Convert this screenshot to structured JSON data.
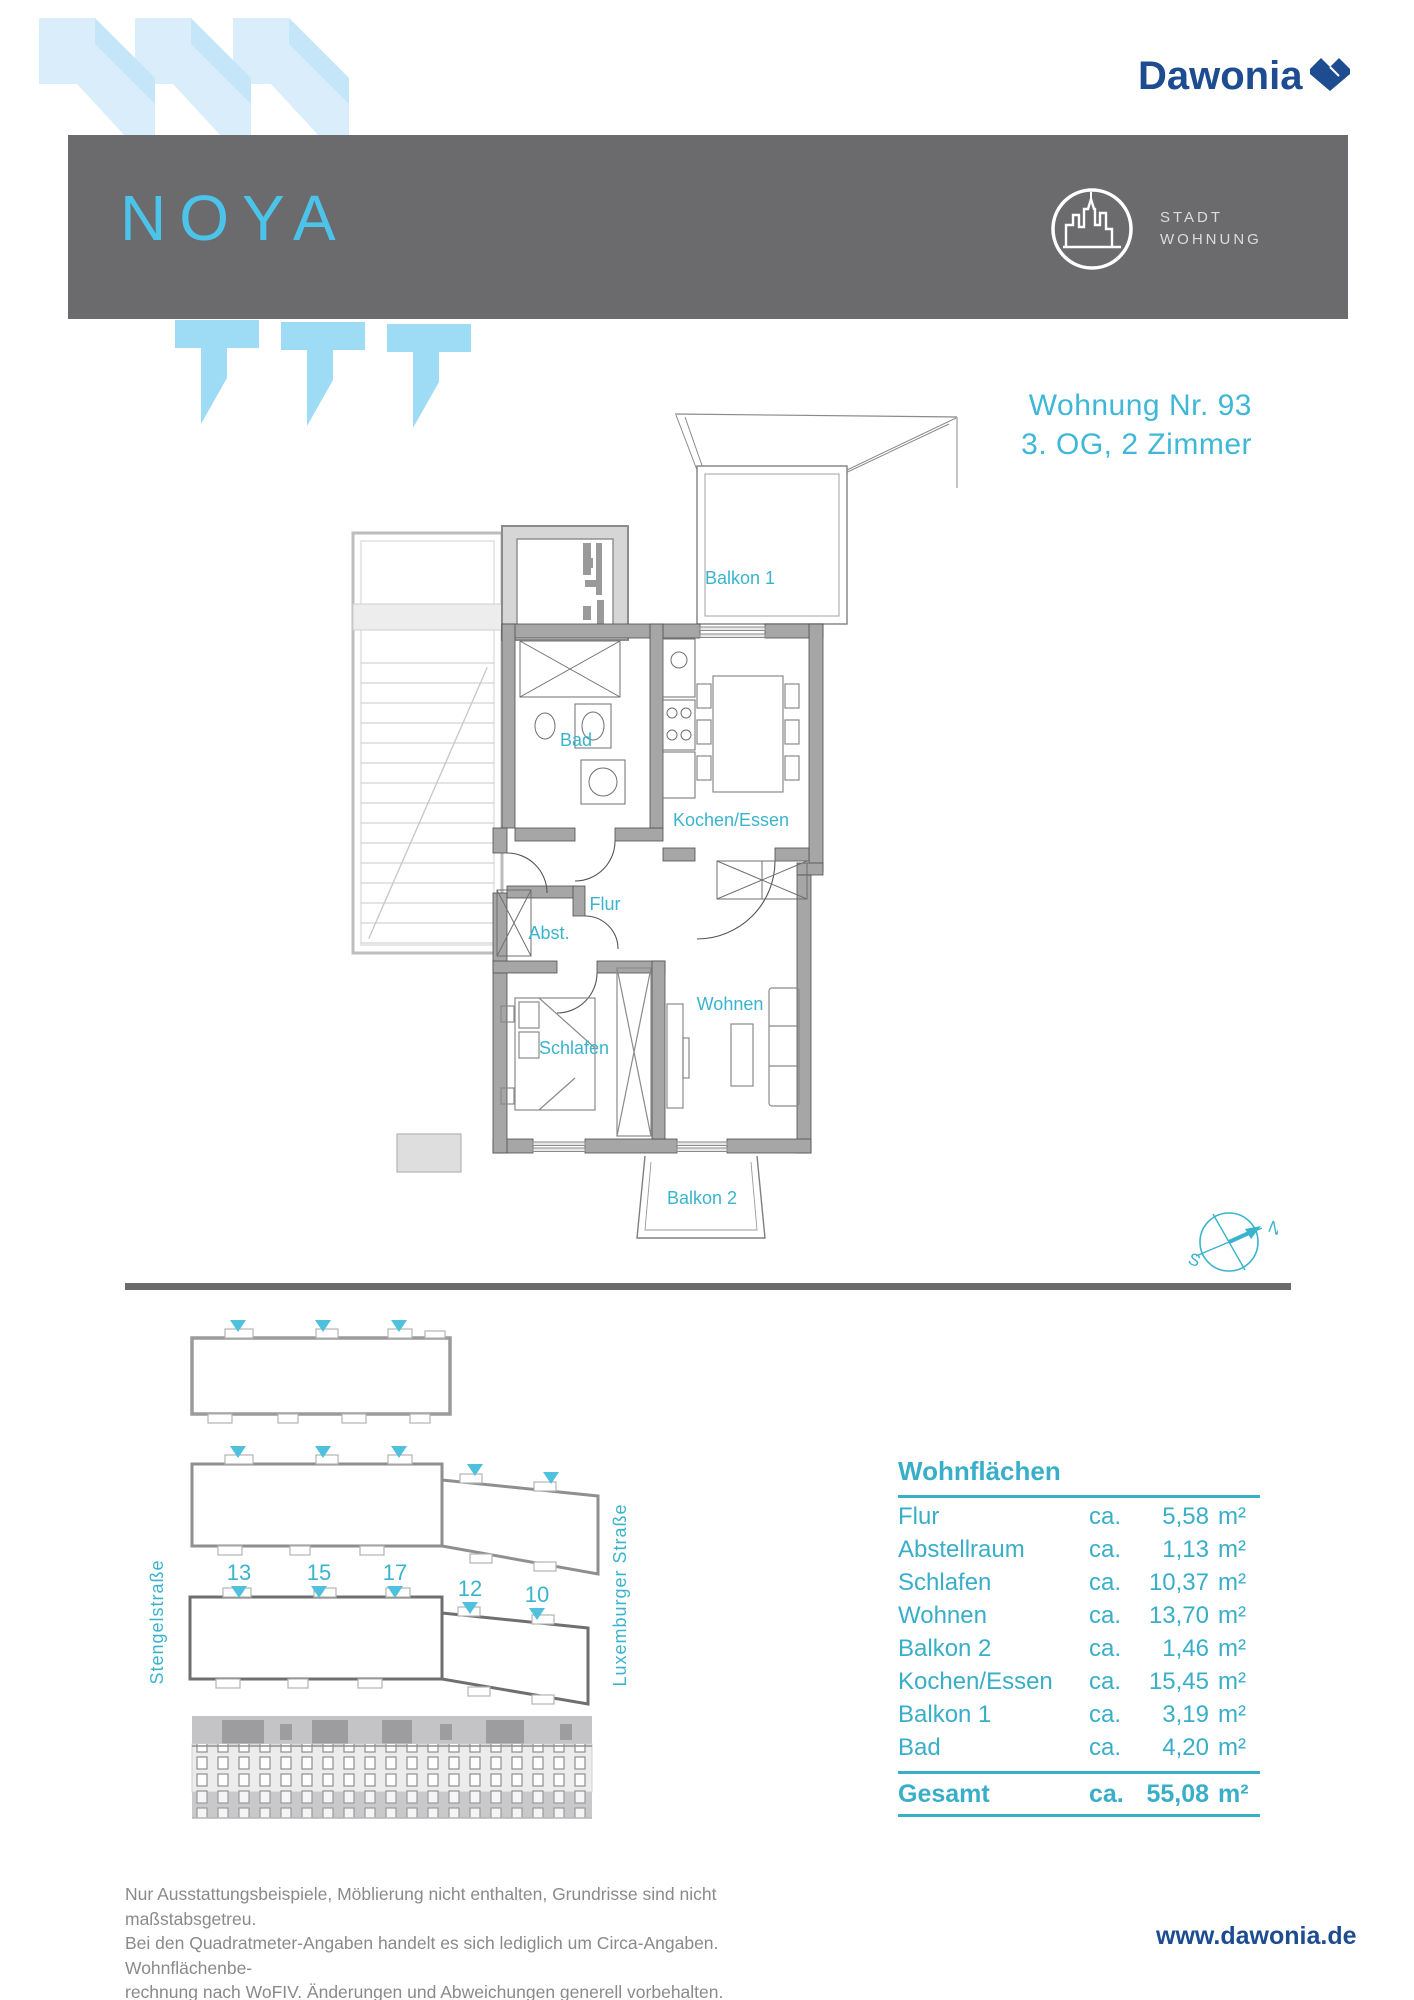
{
  "brand": {
    "logo_text": "Dawonia",
    "website": "www.dawonia.de",
    "navy": "#1d4c90",
    "heart_icon": "heart-icon"
  },
  "header": {
    "project_name": "NOYA",
    "bar_color": "#6b6b6e",
    "accent_blue": "#4cc3e9",
    "badge": {
      "icon": "city-skyline-icon",
      "line1": "STADT",
      "line2": "WOHNUNG"
    }
  },
  "apartment": {
    "title_line1": "Wohnung Nr. 93",
    "title_line2": "3. OG, 2 Zimmer"
  },
  "floorplan": {
    "rooms": {
      "balkon1": "Balkon 1",
      "bad": "Bad",
      "kochen": "Kochen/Essen",
      "flur": "Flur",
      "abst": "Abst.",
      "schlafen": "Schlafen",
      "wohnen": "Wohnen",
      "balkon2": "Balkon 2"
    },
    "compass": {
      "icon": "compass-icon",
      "north": "N",
      "south": "S"
    }
  },
  "siteplan": {
    "street_left": "Stengelstraße",
    "street_right": "Luxemburger Straße",
    "house_numbers": [
      "13",
      "15",
      "17",
      "12",
      "10"
    ],
    "marker_icon": "entrance-triangle-icon"
  },
  "areas": {
    "title": "Wohnflächen",
    "rows": [
      {
        "label": "Flur",
        "ca": "ca.",
        "value": "5,58",
        "unit": "m²"
      },
      {
        "label": "Abstellraum",
        "ca": "ca.",
        "value": "1,13",
        "unit": "m²"
      },
      {
        "label": "Schlafen",
        "ca": "ca.",
        "value": "10,37",
        "unit": "m²"
      },
      {
        "label": "Wohnen",
        "ca": "ca.",
        "value": "13,70",
        "unit": "m²"
      },
      {
        "label": "Balkon 2",
        "ca": "ca.",
        "value": "1,46",
        "unit": "m²"
      },
      {
        "label": "Kochen/Essen",
        "ca": "ca.",
        "value": "15,45",
        "unit": "m²"
      },
      {
        "label": "Balkon 1",
        "ca": "ca.",
        "value": "3,19",
        "unit": "m²"
      },
      {
        "label": "Bad",
        "ca": "ca.",
        "value": "4,20",
        "unit": "m²"
      }
    ],
    "total": {
      "label": "Gesamt",
      "ca": "ca.",
      "value": "55,08",
      "unit": "m²"
    },
    "teal": "#39aec9"
  },
  "footer": {
    "line1": "Nur Ausstattungsbeispiele, Möblierung nicht enthalten, Grundrisse sind nicht maßstabsgetreu.",
    "line2": "Bei den Quadratmeter-Angaben handelt es sich lediglich um Circa-Angaben. Wohnflächenbe-",
    "line3": "rechnung nach WoFIV. Änderungen und Abweichungen generell vorbehalten."
  },
  "colors": {
    "teal_labels": "#3ab4cd",
    "deco_light_blue": "#d9eefa",
    "deco_mid_blue": "#9edcf5",
    "wall_gray": "#a6a6a6",
    "bar_gray": "#6b6b6e"
  }
}
